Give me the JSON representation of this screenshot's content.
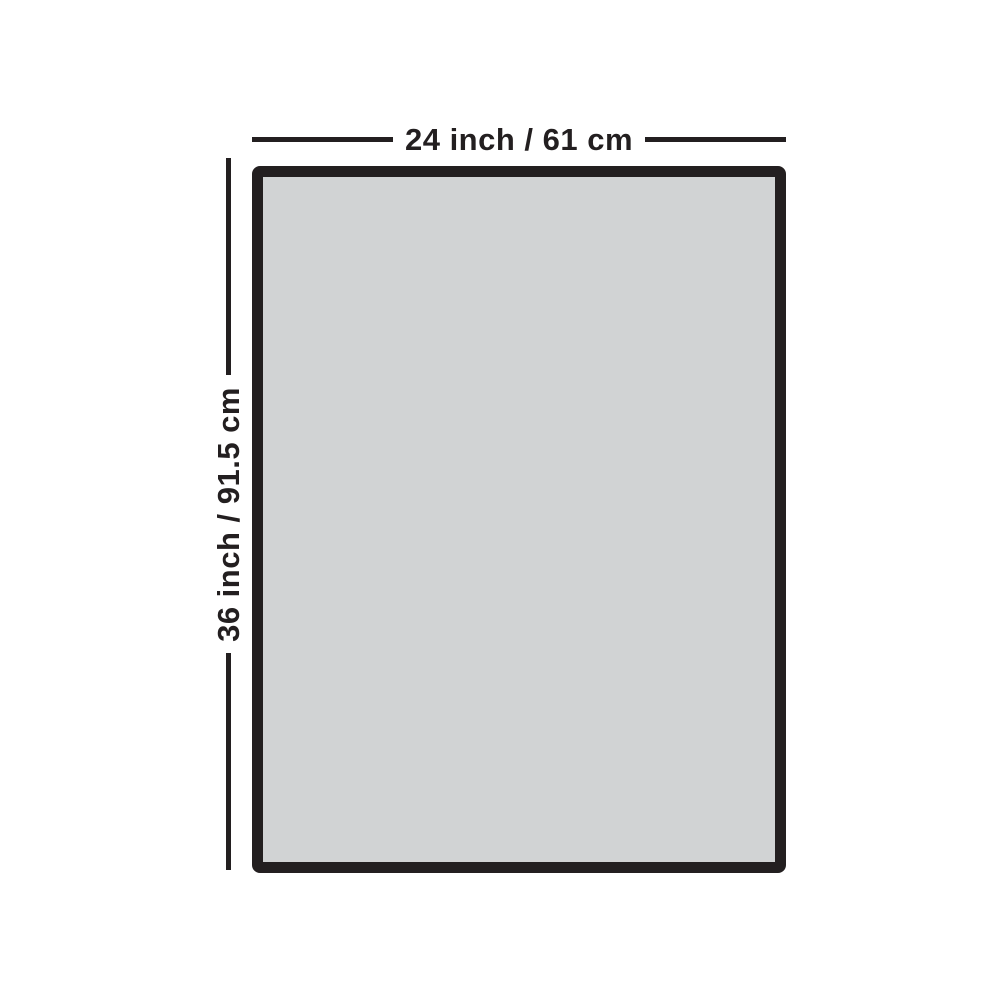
{
  "diagram": {
    "type": "product-dimension-diagram",
    "panel": {
      "shape": "rectangle",
      "fill": "#d1d3d4",
      "border_color": "#231f20",
      "border_thickness_px": 11
    },
    "width_dimension": {
      "label": "24 inch / 61 cm",
      "orientation": "horizontal",
      "position": "above-panel"
    },
    "height_dimension": {
      "label": "36 inch / 91.5 cm",
      "orientation": "vertical",
      "position": "left-of-panel",
      "reading_direction": "bottom-to-top"
    },
    "colors": {
      "line": "#231f20",
      "text": "#231f20",
      "panel_fill": "#d1d3d4",
      "panel_border": "#231f20",
      "background": "#ffffff"
    }
  }
}
